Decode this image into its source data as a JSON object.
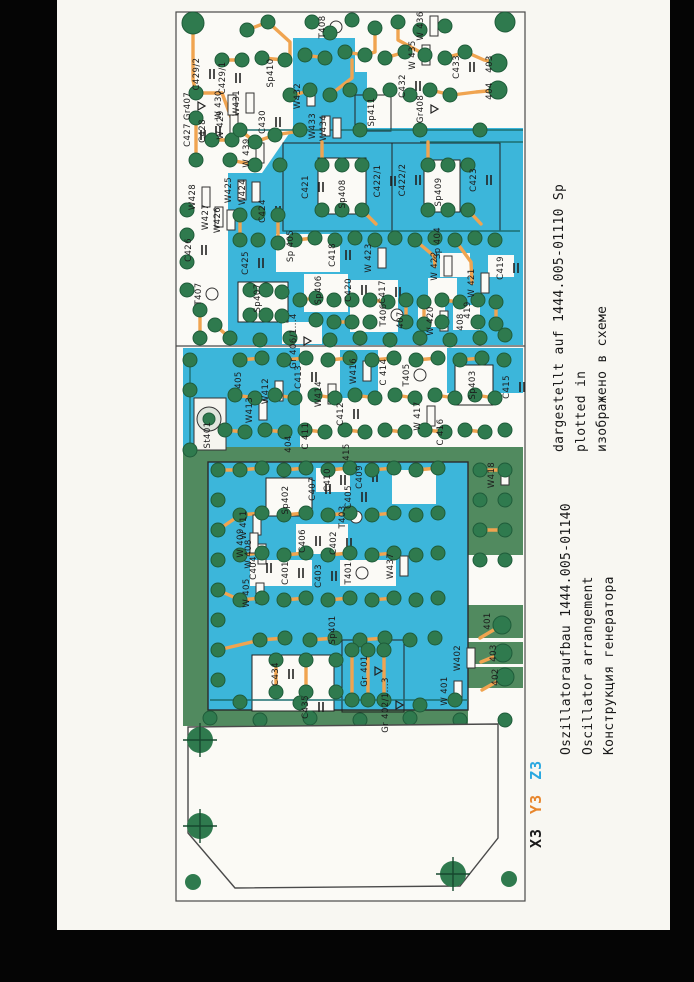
{
  "colors": {
    "copper_teal": "#3cb6da",
    "copper_olive": "#518a5f",
    "trace_orange": "#f0a450",
    "pad_green": "#2f7a4e",
    "pad_rim": "#1f5c3a",
    "accent_orange": "#e8862c",
    "accent_cyan": "#2aa8e0",
    "page_bg": "#f8f7f2"
  },
  "captions": {
    "left_block": {
      "line1": "Oszillatoraufbau 1444.005-01140",
      "line2": "Oscillator arrangement",
      "line3": "Конструкция генератора"
    },
    "right_block": {
      "line1": "dargestellt auf 1444.005-01110 Sp",
      "line2": "plotted in",
      "line3": "изображено в схеме"
    },
    "connector": {
      "parts": [
        {
          "text": "X3",
          "color": "#1a1a1a"
        },
        {
          "text": "Y3",
          "color": "#e8862c"
        },
        {
          "text": "Z3",
          "color": "#2aa8e0"
        }
      ]
    }
  },
  "board": {
    "labels": [
      {
        "text": "C428",
        "x": 203,
        "y": 131
      },
      {
        "text": "W431",
        "x": 237,
        "y": 103
      },
      {
        "text": "T408",
        "x": 323,
        "y": 27
      },
      {
        "text": "C433",
        "x": 457,
        "y": 67
      },
      {
        "text": "W 436",
        "x": 421,
        "y": 26
      },
      {
        "text": "W 435",
        "x": 413,
        "y": 55
      },
      {
        "text": "C429/2",
        "x": 197,
        "y": 74
      },
      {
        "text": "C429/1",
        "x": 223,
        "y": 78
      },
      {
        "text": "Sp410",
        "x": 271,
        "y": 73
      },
      {
        "text": "Gr407",
        "x": 188,
        "y": 106
      },
      {
        "text": "C427",
        "x": 188,
        "y": 135
      },
      {
        "text": "W 430",
        "x": 219,
        "y": 105
      },
      {
        "text": "W 429",
        "x": 221,
        "y": 125
      },
      {
        "text": "C430",
        "x": 263,
        "y": 122
      },
      {
        "text": "W432",
        "x": 298,
        "y": 96
      },
      {
        "text": "W433",
        "x": 313,
        "y": 126
      },
      {
        "text": "W434",
        "x": 324,
        "y": 128
      },
      {
        "text": "W 439",
        "x": 247,
        "y": 153
      },
      {
        "text": "Sp411",
        "x": 372,
        "y": 112
      },
      {
        "text": "C432",
        "x": 403,
        "y": 86
      },
      {
        "text": "Gr408",
        "x": 421,
        "y": 109
      },
      {
        "text": "403",
        "x": 490,
        "y": 64
      },
      {
        "text": "404",
        "x": 490,
        "y": 91
      },
      {
        "text": "C426",
        "x": 189,
        "y": 250
      },
      {
        "text": "W428",
        "x": 193,
        "y": 197
      },
      {
        "text": "W427",
        "x": 206,
        "y": 217
      },
      {
        "text": "W426",
        "x": 218,
        "y": 220
      },
      {
        "text": "W425",
        "x": 229,
        "y": 190
      },
      {
        "text": "W424",
        "x": 243,
        "y": 192
      },
      {
        "text": "C424",
        "x": 263,
        "y": 211
      },
      {
        "text": "C425",
        "x": 246,
        "y": 263
      },
      {
        "text": "T407",
        "x": 199,
        "y": 294
      },
      {
        "text": "Sp407",
        "x": 258,
        "y": 298
      },
      {
        "text": "Gr 406/1...4",
        "x": 294,
        "y": 341
      },
      {
        "text": "Sp 405",
        "x": 291,
        "y": 246
      },
      {
        "text": "C418",
        "x": 333,
        "y": 255
      },
      {
        "text": "C421",
        "x": 306,
        "y": 187
      },
      {
        "text": "Sp408",
        "x": 343,
        "y": 194
      },
      {
        "text": "C422/1",
        "x": 378,
        "y": 181
      },
      {
        "text": "C422/2",
        "x": 403,
        "y": 180
      },
      {
        "text": "Sp409",
        "x": 439,
        "y": 192
      },
      {
        "text": "C423",
        "x": 474,
        "y": 180
      },
      {
        "text": "W 423",
        "x": 369,
        "y": 258
      },
      {
        "text": "Sp 404",
        "x": 438,
        "y": 243
      },
      {
        "text": "W 422",
        "x": 435,
        "y": 266
      },
      {
        "text": "W 421",
        "x": 472,
        "y": 283
      },
      {
        "text": "C419",
        "x": 501,
        "y": 268
      },
      {
        "text": "419",
        "x": 468,
        "y": 310
      },
      {
        "text": "W 420",
        "x": 431,
        "y": 321
      },
      {
        "text": "408",
        "x": 461,
        "y": 322
      },
      {
        "text": "Sp406",
        "x": 319,
        "y": 290
      },
      {
        "text": "C420",
        "x": 349,
        "y": 290
      },
      {
        "text": "C417",
        "x": 383,
        "y": 292
      },
      {
        "text": "T406",
        "x": 384,
        "y": 315
      },
      {
        "text": "407",
        "x": 401,
        "y": 320
      },
      {
        "text": "St401",
        "x": 208,
        "y": 435
      },
      {
        "text": "405",
        "x": 239,
        "y": 380
      },
      {
        "text": "W412",
        "x": 266,
        "y": 391
      },
      {
        "text": "W413",
        "x": 250,
        "y": 410
      },
      {
        "text": "C413",
        "x": 299,
        "y": 377
      },
      {
        "text": "W414",
        "x": 319,
        "y": 394
      },
      {
        "text": "C412",
        "x": 341,
        "y": 414
      },
      {
        "text": "C 411",
        "x": 306,
        "y": 436
      },
      {
        "text": "404",
        "x": 289,
        "y": 444
      },
      {
        "text": "W416",
        "x": 354,
        "y": 371
      },
      {
        "text": "C 414",
        "x": 384,
        "y": 372
      },
      {
        "text": "T405",
        "x": 407,
        "y": 375
      },
      {
        "text": "Sp403",
        "x": 473,
        "y": 385
      },
      {
        "text": "C415",
        "x": 507,
        "y": 387
      },
      {
        "text": "W 417",
        "x": 418,
        "y": 416
      },
      {
        "text": "C 416",
        "x": 441,
        "y": 432
      },
      {
        "text": "W418",
        "x": 492,
        "y": 475
      },
      {
        "text": "415",
        "x": 347,
        "y": 452
      },
      {
        "text": "C409",
        "x": 360,
        "y": 477
      },
      {
        "text": "C410",
        "x": 328,
        "y": 480
      },
      {
        "text": "C405",
        "x": 349,
        "y": 497
      },
      {
        "text": "Sp402",
        "x": 286,
        "y": 500
      },
      {
        "text": "C407",
        "x": 313,
        "y": 489
      },
      {
        "text": "W 411",
        "x": 244,
        "y": 525
      },
      {
        "text": "W 409",
        "x": 241,
        "y": 543
      },
      {
        "text": "W 408",
        "x": 249,
        "y": 554
      },
      {
        "text": "C406",
        "x": 303,
        "y": 541
      },
      {
        "text": "C402",
        "x": 334,
        "y": 543
      },
      {
        "text": "T403",
        "x": 343,
        "y": 517
      },
      {
        "text": "C404",
        "x": 254,
        "y": 568
      },
      {
        "text": "C401",
        "x": 286,
        "y": 573
      },
      {
        "text": "C403",
        "x": 319,
        "y": 576
      },
      {
        "text": "T401",
        "x": 349,
        "y": 573
      },
      {
        "text": "W437",
        "x": 391,
        "y": 566
      },
      {
        "text": "W 405",
        "x": 247,
        "y": 593
      },
      {
        "text": "Sp401",
        "x": 333,
        "y": 630
      },
      {
        "text": "C434",
        "x": 276,
        "y": 674
      },
      {
        "text": "C435",
        "x": 306,
        "y": 707
      },
      {
        "text": "Gr 401",
        "x": 365,
        "y": 671
      },
      {
        "text": "Gr 402/1...3",
        "x": 386,
        "y": 705
      },
      {
        "text": "W402",
        "x": 458,
        "y": 658
      },
      {
        "text": "W 401",
        "x": 445,
        "y": 691
      },
      {
        "text": "401",
        "x": 488,
        "y": 621
      },
      {
        "text": "403",
        "x": 494,
        "y": 653
      },
      {
        "text": "402",
        "x": 496,
        "y": 677
      }
    ]
  }
}
